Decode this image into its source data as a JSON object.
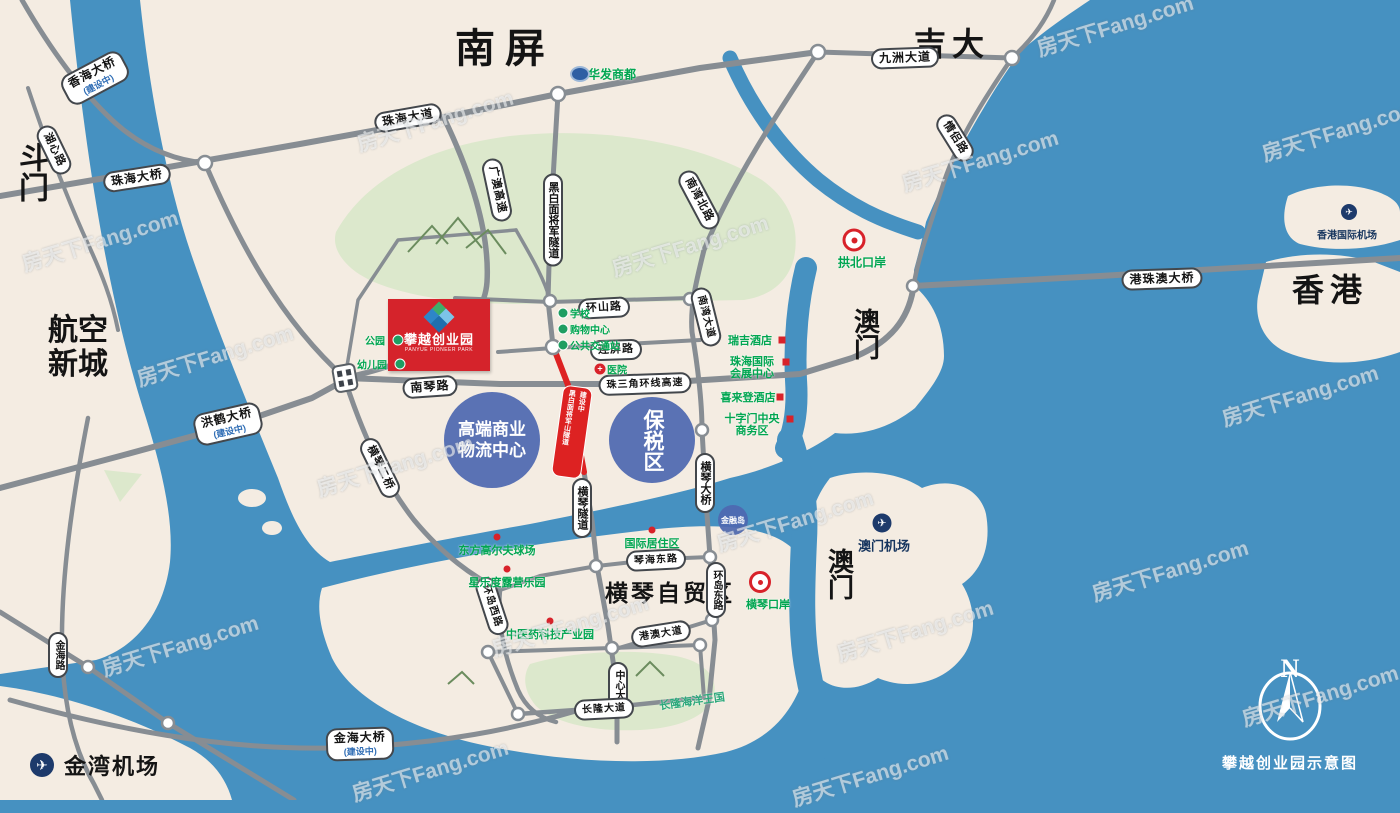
{
  "map": {
    "watermark": {
      "text": "房天下Fang.com"
    },
    "compass": {
      "letter": "N",
      "caption": "攀越创业园示意图"
    },
    "project": {
      "name": "攀越创业园",
      "name_en": "PANYUE PIONEER PARK"
    },
    "highlight_road": {
      "label": "黑白面将军山隧道",
      "note": "建设中"
    },
    "colors": {
      "sea": "#4691c1",
      "land": "#f4ece2",
      "park": "#dce8cc",
      "road": "#878d93",
      "accent_red": "#d5232b",
      "zone_blue": "#4e68b0",
      "poi_green": "#00a651"
    },
    "areas": [
      {
        "label": "南屏"
      },
      {
        "label": "吉大"
      },
      {
        "label": "斗门"
      },
      {
        "label": "航空新城"
      },
      {
        "label": "香港"
      },
      {
        "label": "澳门"
      },
      {
        "label": "澳门"
      },
      {
        "label": "横琴自贸区"
      },
      {
        "label": "金湾机场"
      },
      {
        "label": "澳门机场"
      },
      {
        "label": "香港国际机场"
      }
    ],
    "roads": [
      {
        "label": "香海大桥",
        "note": "(建设中)"
      },
      {
        "label": "湖心路"
      },
      {
        "label": "珠海大桥"
      },
      {
        "label": "珠海大道"
      },
      {
        "label": "九洲大道"
      },
      {
        "label": "情侣路"
      },
      {
        "label": "港珠澳大桥"
      },
      {
        "label": "广澳高速"
      },
      {
        "label": "黑白面将军隧道"
      },
      {
        "label": "南湾北路"
      },
      {
        "label": "环山路"
      },
      {
        "label": "连屏路"
      },
      {
        "label": "珠三角环线高速"
      },
      {
        "label": "南琴路"
      },
      {
        "label": "南湾大道"
      },
      {
        "label": "洪鹤大桥",
        "note": "(建设中)"
      },
      {
        "label": "横琴二桥"
      },
      {
        "label": "横琴隧道"
      },
      {
        "label": "横琴大桥"
      },
      {
        "label": "琴海东路"
      },
      {
        "label": "环岛东路"
      },
      {
        "label": "环岛西路"
      },
      {
        "label": "港澳大道"
      },
      {
        "label": "中心大道"
      },
      {
        "label": "长隆大道"
      },
      {
        "label": "金海路"
      },
      {
        "label": "金海大桥",
        "note": "(建设中)"
      }
    ],
    "pois": [
      {
        "label": "华发商都"
      },
      {
        "label": "拱北口岸"
      },
      {
        "label": "横琴口岸"
      },
      {
        "label": "瑞吉酒店"
      },
      {
        "label": "珠海国际会展中心"
      },
      {
        "label": "喜来登酒店"
      },
      {
        "label": "十字门中央商务区"
      },
      {
        "label": "学校"
      },
      {
        "label": "购物中心"
      },
      {
        "label": "公共交通站"
      },
      {
        "label": "医院"
      },
      {
        "label": "公园"
      },
      {
        "label": "幼儿园"
      },
      {
        "label": "东方高尔夫球场"
      },
      {
        "label": "星乐度露营乐园"
      },
      {
        "label": "中医药科技产业园"
      },
      {
        "label": "国际居住区"
      },
      {
        "label": "长隆海洋王国"
      }
    ],
    "zones": [
      {
        "line1": "高端商业",
        "line2": "物流中心"
      },
      {
        "label": "保税区"
      },
      {
        "label": "金融岛"
      }
    ]
  }
}
